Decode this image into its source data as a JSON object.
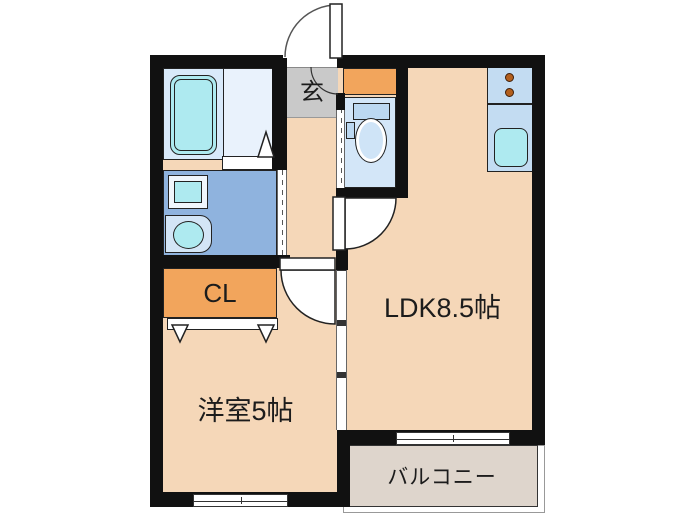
{
  "plan": {
    "title": "1LDK floor plan",
    "rooms": {
      "genkan": {
        "label": "玄"
      },
      "closet": {
        "label": "CL"
      },
      "ldk": {
        "label": "LDK8.5帖"
      },
      "western_room": {
        "label": "洋室5帖"
      },
      "balcony": {
        "label": "バルコニー"
      }
    },
    "fixtures": [
      "bathtub",
      "washing-machine",
      "vanity-sink",
      "toilet",
      "toilet-remote",
      "kitchen-stove-2-burner",
      "kitchen-sink",
      "shoe-cabinet",
      "entrance-door",
      "ldk-door",
      "western-room-door",
      "closet-sliding-doors",
      "sliding-partition",
      "balcony-sliding-door",
      "window"
    ],
    "colors": {
      "wall": "#111111",
      "floor_peach": "#f5d7b8",
      "genkan_gray": "#c9c9c9",
      "washroom_blue": "#8fb3de",
      "bathroom_blue": "#d9eafa",
      "bath_wash_area": "#e9f2fc",
      "fixture_cyan": "#aeeaf0",
      "unit_blue": "#c3dcf2",
      "toilet_room_blue": "#d3e6f8",
      "closet_orange": "#f2a55c",
      "balcony_beige": "#ded5cc",
      "burner_brown": "#b35f1d"
    }
  }
}
